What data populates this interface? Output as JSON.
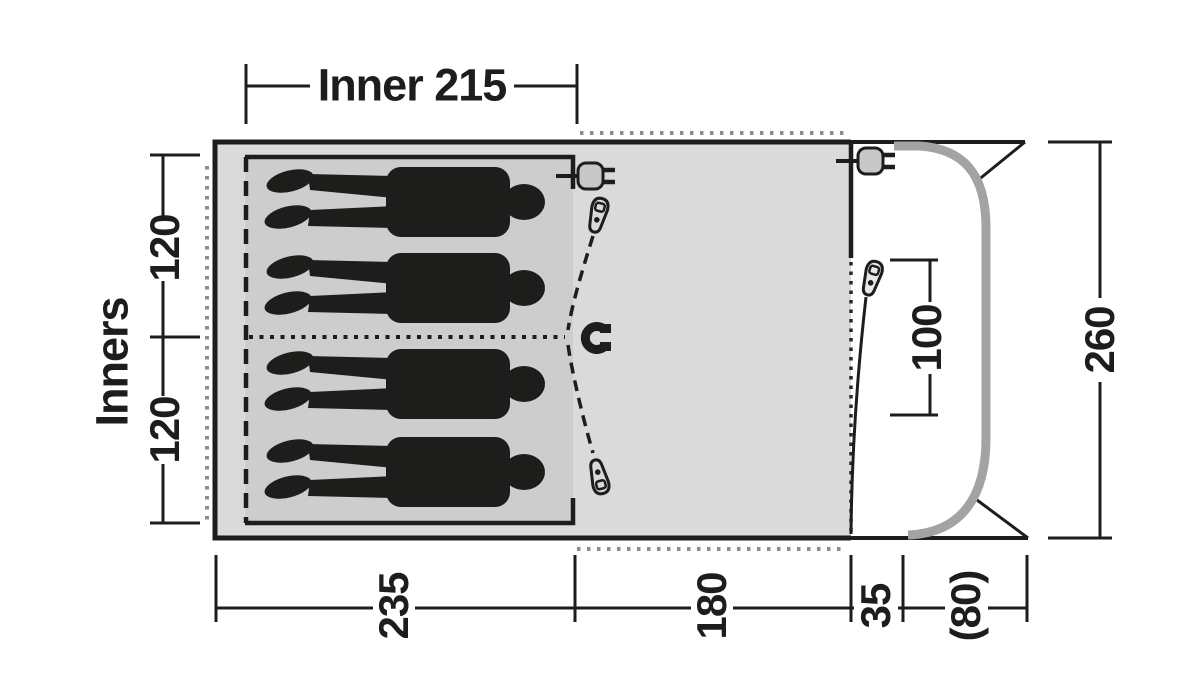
{
  "diagram": {
    "type": "tent-floorplan",
    "dimensions": {
      "inner_width": "Inner 215",
      "inners_label": "Inners",
      "bedroom_top": "120",
      "bedroom_bottom": "120",
      "depth_sleeping": "235",
      "depth_living": "180",
      "depth_front": "35",
      "depth_canopy": "(80)",
      "door_height": "100",
      "width_total": "260"
    },
    "icons": {
      "power_inlets": "plug-icon",
      "door_zips": "zipper-pull-icon",
      "door_closure": "magnet-icon",
      "sleepers": "person-silhouette"
    },
    "people_count": 4,
    "colors": {
      "outline": "#1d1d1b",
      "body_fill": "#dadada",
      "inner_fill": "#cdcdcd",
      "pole": "#a3a3a3",
      "flap_dots": "#8c8c8c",
      "background": "#ffffff"
    }
  }
}
